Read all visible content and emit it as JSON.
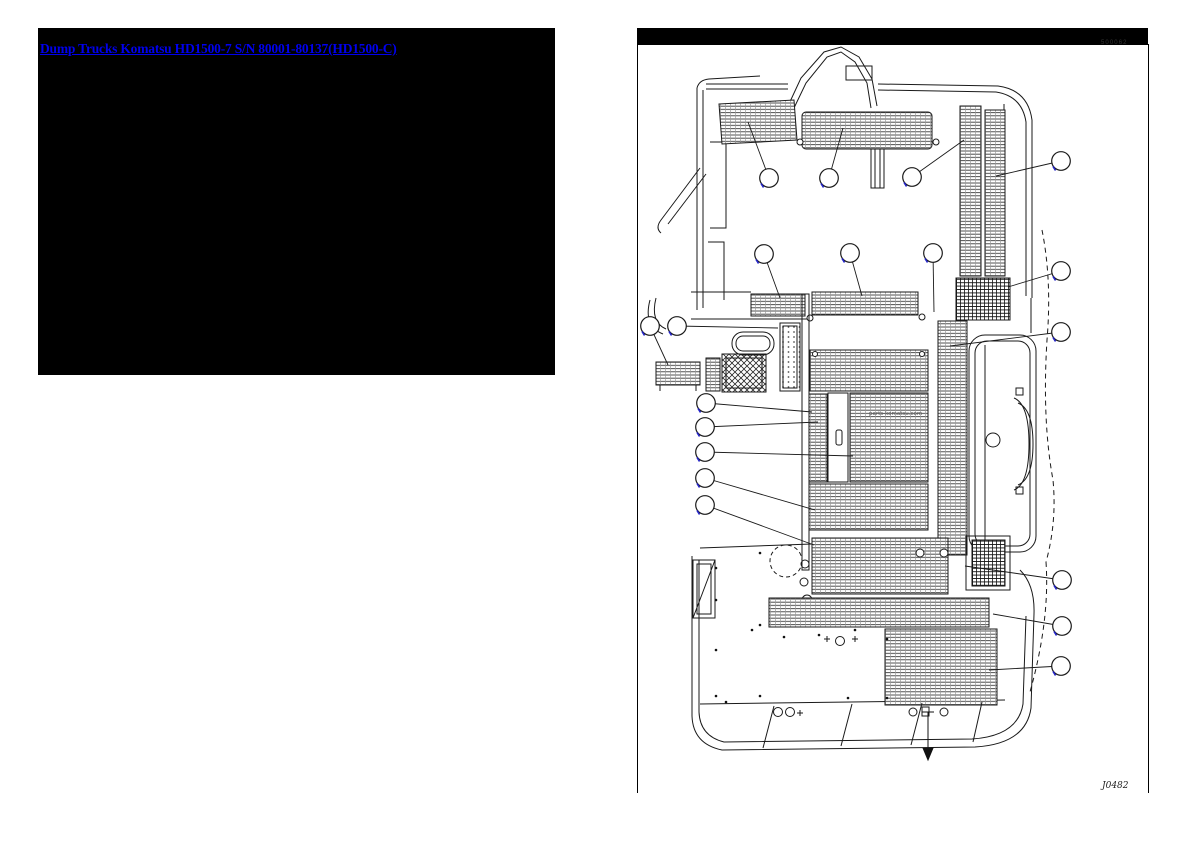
{
  "page": {
    "background": "#ffffff"
  },
  "catalog_link": {
    "text": "Dump Trucks Komatsu HD1500-7 S/N 80001-80137(HD1500-C)",
    "color": "#0000ee",
    "panel_background": "#000000"
  },
  "diagram": {
    "frame_color": "#000000",
    "corner_code": "500062",
    "drawing_number": "J0482",
    "watermark": "parts-komatsu.com",
    "balloon_link_color": "#2323cc",
    "line_color": "#1a1a1a",
    "callouts": [
      {
        "x": 769,
        "y": 178
      },
      {
        "x": 829,
        "y": 178
      },
      {
        "x": 912,
        "y": 177
      },
      {
        "x": 1061,
        "y": 161
      },
      {
        "x": 764,
        "y": 254
      },
      {
        "x": 850,
        "y": 253
      },
      {
        "x": 933,
        "y": 253
      },
      {
        "x": 1061,
        "y": 271
      },
      {
        "x": 650,
        "y": 326
      },
      {
        "x": 677,
        "y": 326
      },
      {
        "x": 1061,
        "y": 332
      },
      {
        "x": 706,
        "y": 403
      },
      {
        "x": 705,
        "y": 427
      },
      {
        "x": 705,
        "y": 452
      },
      {
        "x": 705,
        "y": 478
      },
      {
        "x": 705,
        "y": 505
      },
      {
        "x": 1062,
        "y": 580
      },
      {
        "x": 1062,
        "y": 626
      },
      {
        "x": 1061,
        "y": 666
      }
    ],
    "leaders": [
      {
        "x1": 769,
        "y1": 178,
        "x2": 748,
        "y2": 122
      },
      {
        "x1": 829,
        "y1": 178,
        "x2": 843,
        "y2": 128
      },
      {
        "x1": 912,
        "y1": 177,
        "x2": 964,
        "y2": 140
      },
      {
        "x1": 1061,
        "y1": 161,
        "x2": 996,
        "y2": 176
      },
      {
        "x1": 764,
        "y1": 254,
        "x2": 780,
        "y2": 298
      },
      {
        "x1": 850,
        "y1": 253,
        "x2": 862,
        "y2": 296
      },
      {
        "x1": 933,
        "y1": 253,
        "x2": 934,
        "y2": 312
      },
      {
        "x1": 1061,
        "y1": 271,
        "x2": 1008,
        "y2": 287
      },
      {
        "x1": 650,
        "y1": 326,
        "x2": 668,
        "y2": 365
      },
      {
        "x1": 677,
        "y1": 326,
        "x2": 778,
        "y2": 328
      },
      {
        "x1": 1061,
        "y1": 332,
        "x2": 950,
        "y2": 346
      },
      {
        "x1": 706,
        "y1": 403,
        "x2": 812,
        "y2": 412
      },
      {
        "x1": 705,
        "y1": 427,
        "x2": 818,
        "y2": 422
      },
      {
        "x1": 705,
        "y1": 452,
        "x2": 853,
        "y2": 456
      },
      {
        "x1": 705,
        "y1": 478,
        "x2": 815,
        "y2": 510
      },
      {
        "x1": 705,
        "y1": 505,
        "x2": 814,
        "y2": 545
      },
      {
        "x1": 1062,
        "y1": 580,
        "x2": 965,
        "y2": 566
      },
      {
        "x1": 1062,
        "y1": 626,
        "x2": 993,
        "y2": 614
      },
      {
        "x1": 1061,
        "y1": 666,
        "x2": 989,
        "y2": 670
      }
    ]
  }
}
